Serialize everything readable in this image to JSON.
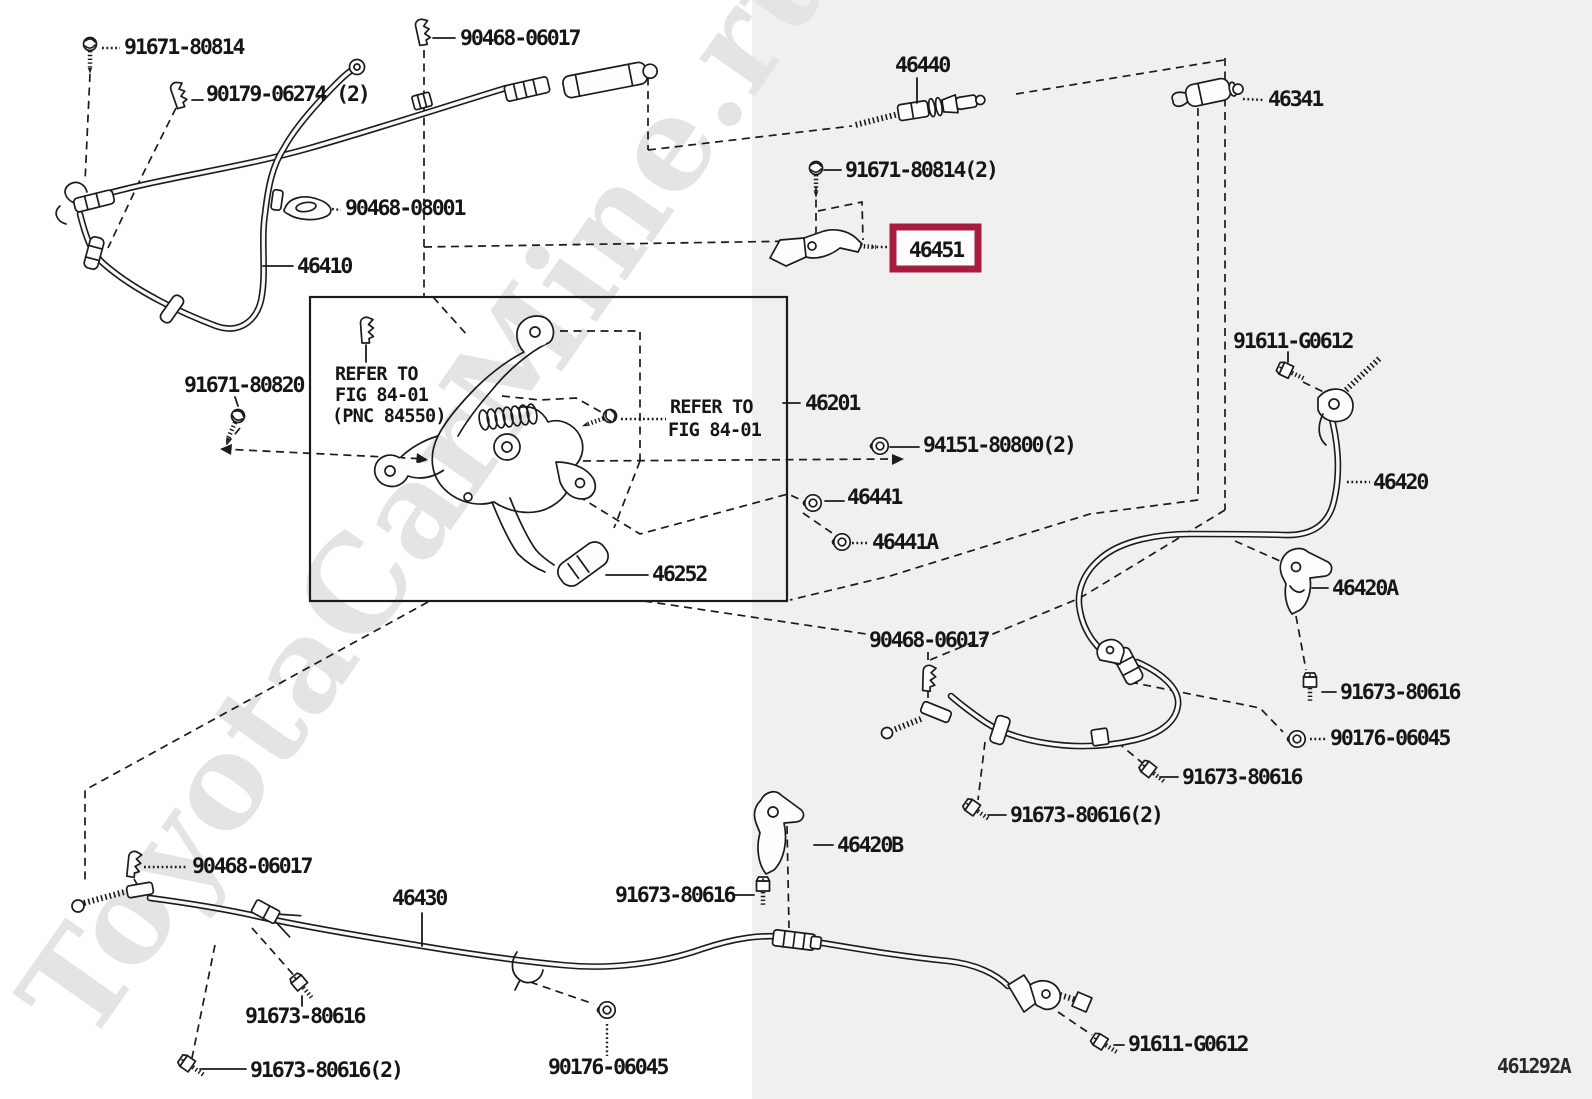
{
  "diagram": {
    "code": "461292A",
    "watermark": "ToyotaCarMine.ru",
    "highlighted_part": "46451",
    "colors": {
      "highlight_box": "#a81c3e",
      "bg_left": "#ffffff",
      "bg_right": "#f0f0f1",
      "line": "#1b1b1b"
    },
    "notes": {
      "left": [
        "REFER TO",
        "FIG 84-01",
        "(PNC 84550)"
      ],
      "right": [
        "REFER TO",
        "FIG 84-01"
      ]
    },
    "labels": {
      "l0": "91671-80814",
      "l1": "90179-06274 (2)",
      "l2": "90468-06017",
      "l3": "46440",
      "l4": "46341",
      "l5": "91671-80814(2)",
      "l6": "46451",
      "l7": "90468-08001",
      "l8": "46410",
      "l9": "91671-80820",
      "l10": "46201",
      "l11": "94151-80800(2)",
      "l12": "46441",
      "l13": "46441A",
      "l14": "46252",
      "l15": "91611-G0612",
      "l16": "46420",
      "l17": "46420A",
      "l18": "90468-06017",
      "l19": "91673-80616",
      "l20": "90176-06045",
      "l21": "91673-80616",
      "l22": "91673-80616(2)",
      "l23": "46420B",
      "l24": "91673-80616",
      "l25": "90468-06017",
      "l26": "46430",
      "l27": "91673-80616",
      "l28": "91673-80616(2)",
      "l29": "90176-06045",
      "l30": "91611-G0612",
      "l31": "461292A"
    }
  }
}
